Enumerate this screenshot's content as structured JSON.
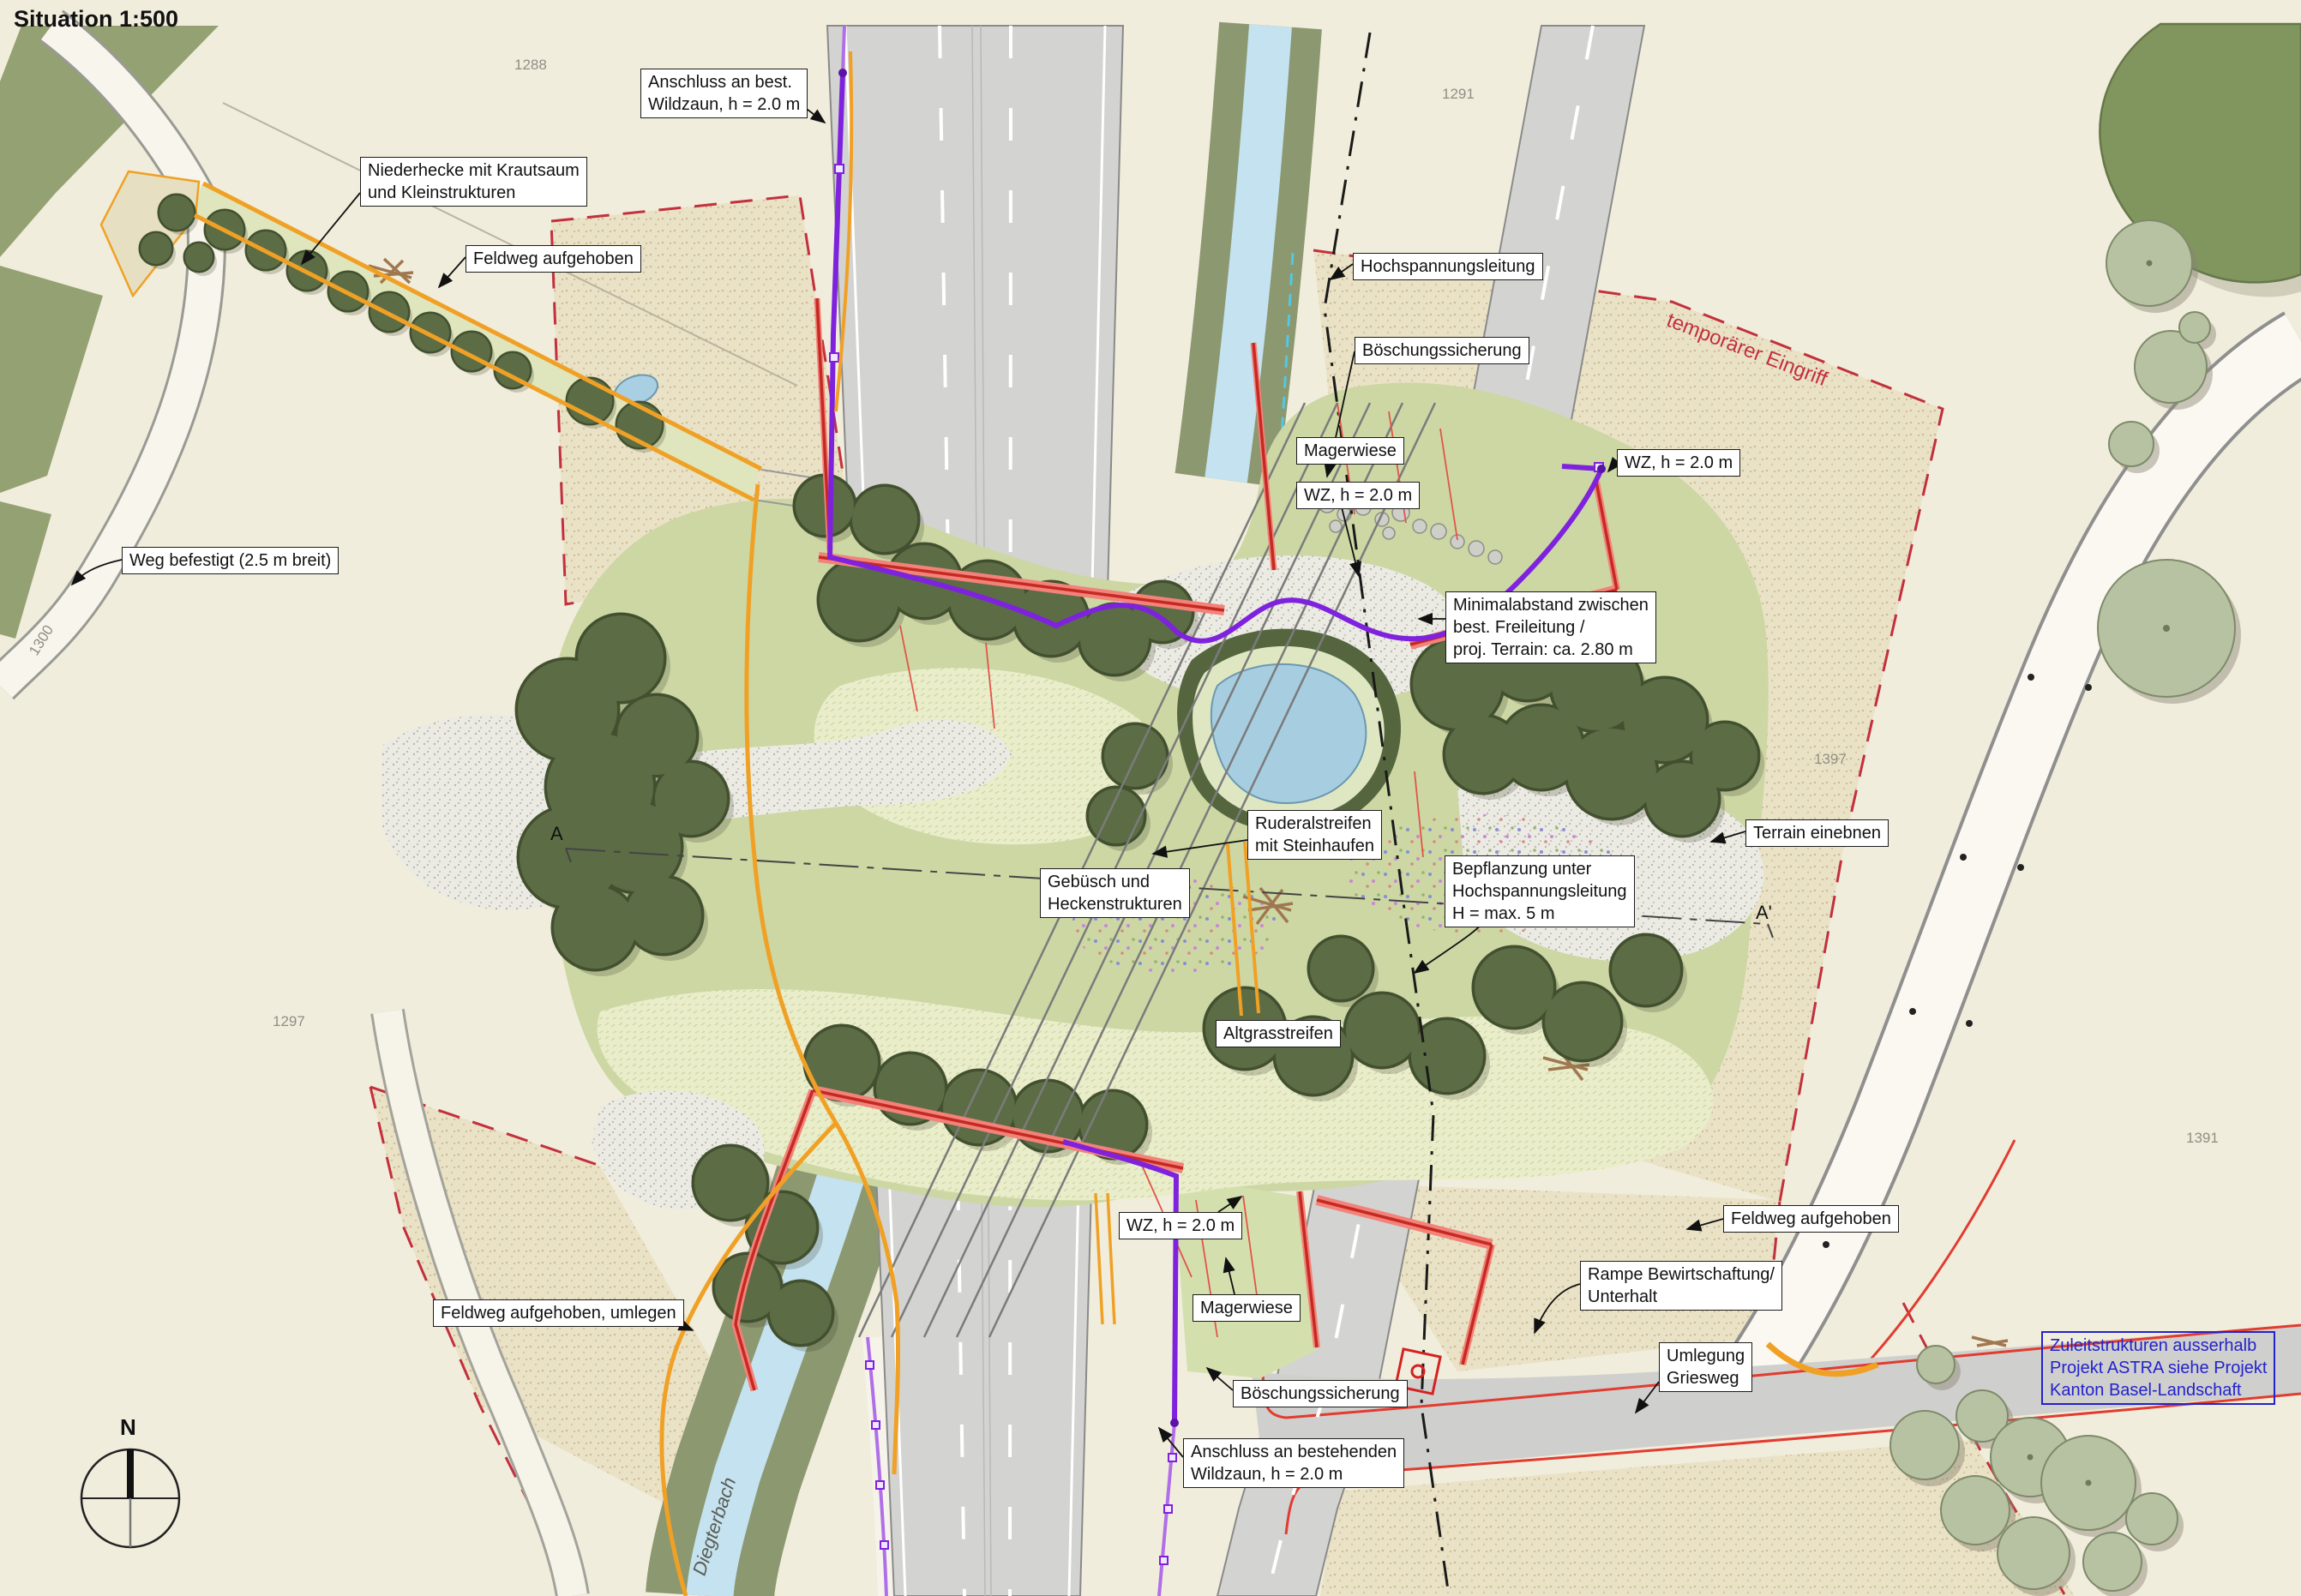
{
  "title": "Situation 1:500",
  "annotations": {
    "anschluss_top": "Anschluss an best.\nWildzaun, h = 2.0 m",
    "niederhecke": "Niederhecke mit Krautsaum\nund Kleinstrukturen",
    "feldweg_top": "Feldweg aufgehoben",
    "hochspannungsleitung": "Hochspannungsleitung",
    "boeschungssicherung_top": "Böschungssicherung",
    "magerwiese_top": "Magerwiese",
    "wz_top_left": "WZ, h = 2.0 m",
    "wz_top_right": "WZ, h = 2.0 m",
    "temporaerer_eingriff": "temporärer Eingriff",
    "minimalabstand": "Minimalabstand zwischen\nbest.   Freileitung /\nproj. Terrain: ca. 2.80 m",
    "weg_befestigt": "Weg befestigt (2.5 m breit)",
    "ruderalstreifen": "Ruderalstreifen\nmit Steinhaufen",
    "gebuesch": "Gebüsch und\nHeckenstrukturen",
    "bepflanzung": "Bepflanzung unter\nHochspannungsleitung\nH = max. 5 m",
    "terrain_einebnen": "Terrain einebnen",
    "altgrasstreifen": "Altgrasstreifen",
    "wz_bottom": "WZ, h = 2.0 m",
    "magerwiese_bottom": "Magerwiese",
    "boeschungssicherung_bottom": "Böschungssicherung",
    "anschluss_bottom": "Anschluss an bestehenden\nWildzaun, h = 2.0 m",
    "feldweg_umlegen": "Feldweg aufgehoben, umlegen",
    "rampe": "Rampe Bewirtschaftung/\nUnterhalt",
    "umlegung_griesweg": "Umlegung\nGriesweg",
    "feldweg_right": "Feldweg aufgehoben",
    "zuleit_note": "Zuleitstrukturen ausserhalb\nProjekt ASTRA siehe Projekt\nKanton Basel-Landschaft"
  },
  "markers": {
    "north": "N",
    "section_a": "A",
    "section_a_prime": "A'"
  },
  "water": {
    "stream_label": "Diegterbach"
  },
  "parcels": {
    "p1288": "1288",
    "p1291": "1291",
    "p1297": "1297",
    "p1300": "1300",
    "p1397": "1397",
    "p1391": "1391"
  },
  "colors": {
    "background": "#f1eddc",
    "field_green": "#94a172",
    "bridge_meadow": "#ccd7a4",
    "tree_dark": "#5c6d45",
    "road_gray": "#d3d3d1",
    "stream_blue": "#a7cde0",
    "wall_red": "#f2827a",
    "wall_red_core": "#c52a22",
    "boundary_red_dash": "#c2303e",
    "fence_new_purple": "#7e22dd",
    "fence_existing_purple": "#b06fe8",
    "path_orange": "#f0a125",
    "note_blue": "#2323cc"
  }
}
